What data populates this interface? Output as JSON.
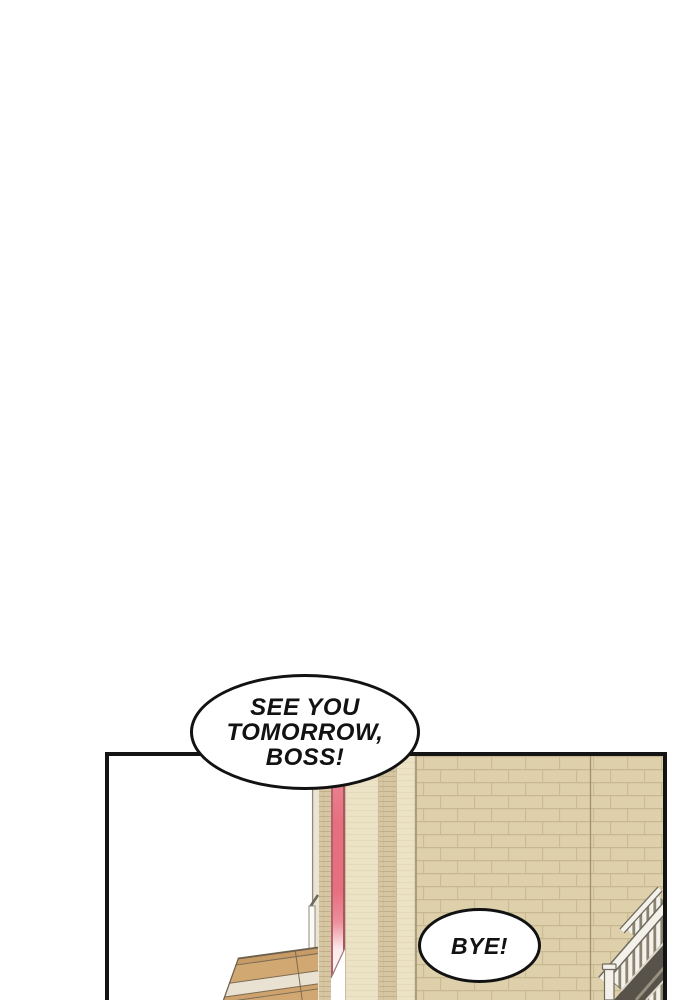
{
  "scene": {
    "speech_bubbles": [
      {
        "id": "boss",
        "lines": [
          "SEE YOU",
          "TOMORROW,",
          "BOSS!"
        ]
      },
      {
        "id": "bye",
        "lines": [
          "BYE!"
        ]
      }
    ]
  },
  "colors": {
    "paper": "#ffffff",
    "panel_border": "#141414",
    "bubble_fill": "#ffffff",
    "bubble_border": "#121212",
    "text": "#121212",
    "wall": "#ddd0ab",
    "wall_mortar": "#c7b890",
    "wall_seam": "#a3916f",
    "wall_shadow_edge": "#a5947a",
    "facade_brick": "#d6c6a2",
    "facade_mortar": "#bcab86",
    "pillar": "#ece2c6",
    "pillar_line": "#d8cba6",
    "edge_strip": "#ebe4d2",
    "edge_outline": "#8f8a7c",
    "pipe_white": "#fbfaf6",
    "banner_red": "#e66f7f",
    "banner_edge_left": "#b4606b",
    "banner_edge_right": "#a65561",
    "banner_outline": "#9a7878",
    "awning_tan": "#d2a872",
    "awning_trim": "#c79b66",
    "awning_tan2": "#cda26c",
    "awning_band": "#e9e2d3",
    "awning_line": "#7d6c52",
    "awning_outline": "#6b5f4c",
    "railing_white": "#f3f1ea",
    "railing_outline": "#6f6a5e",
    "railing_edge_light": "#dcd8ca",
    "baluster_gap": "#8a8372",
    "steps_dark": "#57524a",
    "steps_line": "#968f7d"
  }
}
